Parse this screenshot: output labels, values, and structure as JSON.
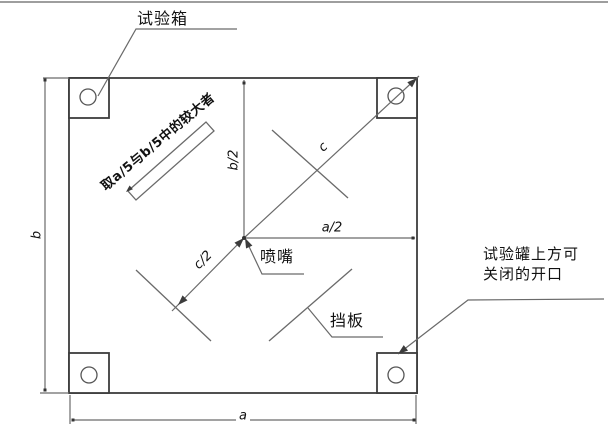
{
  "page": {
    "background": "#ffffff",
    "top_rule_color": "#9e9e9e"
  },
  "diagram": {
    "type": "technical-plan-view",
    "labels": {
      "chamber": "试验箱",
      "nozzle": "喷嘴",
      "baffle": "挡板",
      "opening": {
        "line1": "试验罐上方可",
        "line2": "关闭的开口"
      },
      "note": "取a/5与b/5中的较大者"
    },
    "dims": {
      "a": "a",
      "b": "b",
      "a_half": "a/2",
      "b_half": "b/2",
      "c": "c",
      "c_half": "c/2"
    },
    "colors": {
      "thin_line": "#6a6a6a",
      "outline": "#3c3c3c",
      "text": "#111111"
    }
  }
}
